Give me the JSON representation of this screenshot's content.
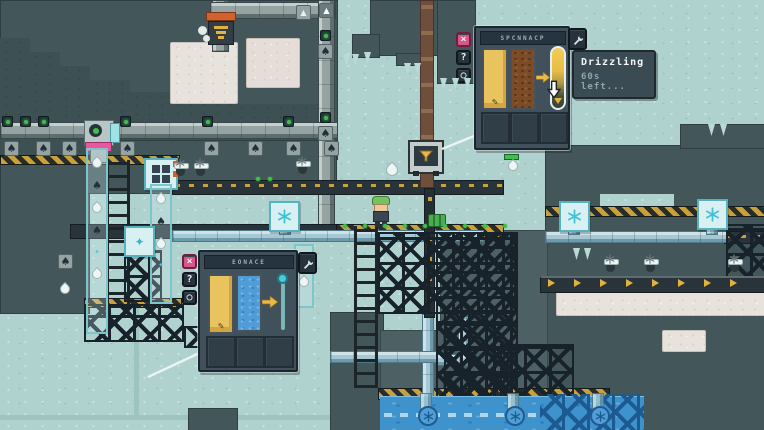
{
  "tooltip": {
    "title": "Drizzling",
    "time_left": "60s left..."
  },
  "panels": {
    "top": {
      "title": "SPCNNACP"
    },
    "bottom": {
      "title": "EONACE"
    }
  },
  "buttons": {
    "close": "×",
    "help": "?",
    "pin": "○"
  },
  "icons": {
    "spade": "♠",
    "crystal": "✦",
    "feather": "✎",
    "up_arrow": "▲",
    "sparkle": "✦",
    "snowflake": "six-spoke-svg",
    "wrench": "wrench-svg",
    "funnel": "funnel-svg",
    "arrow_right": "yellow-arrow-shape",
    "drop": "teardrop-shape"
  },
  "colors": {
    "background": "#b0d2ce",
    "terrain": "#43565a",
    "snow": "#e7e2db",
    "water": "#3e93cd",
    "panel": "#40515b",
    "hazard": "#c9a13b",
    "accent_pink": "#d8568a",
    "accent_yellow": "#ecb84a",
    "accent_cyan": "#49cbd9",
    "light_green": "#3fc04a"
  }
}
